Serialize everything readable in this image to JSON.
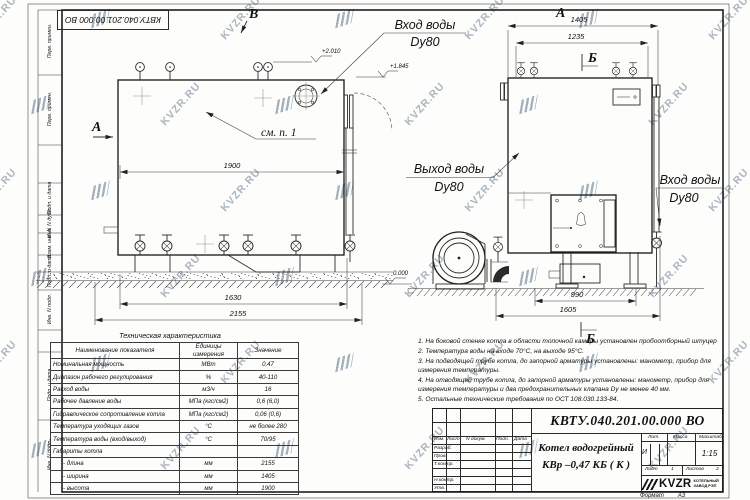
{
  "watermark": {
    "text": "KVZR.RU"
  },
  "frame": {
    "stamp": "КВТУ.040.201.00.000 ВО",
    "margin_labels": [
      "Перв. примен.",
      "Перв. примен.",
      "Подп. и дата",
      "Инв. N дубл.",
      "Взам. инв. N",
      "Подп. и дата",
      "Инв. N подл.",
      "Подп. и дата",
      "Инв. N подл."
    ]
  },
  "front_view": {
    "view_label_b": "В",
    "view_label_a": "А",
    "see_ref": "см. п. 1",
    "dim_1900": "1900",
    "dim_1630": "1630",
    "dim_2155": "2155",
    "elev_top": "+2.010",
    "elev_pipe": "+1.845",
    "inlet_line1": "Вход воды",
    "inlet_line2": "Dy80"
  },
  "side_view": {
    "view_label_a": "А",
    "section_label_top": "Б",
    "section_label_bottom": "Б",
    "dim_1405": "1405",
    "dim_1235": "1235",
    "dim_990": "990",
    "dim_1605": "1605",
    "elev_zero": "0.000",
    "outlet_line1": "Выход воды",
    "outlet_line2": "Dy80",
    "inlet_line1": "Вход воды",
    "inlet_line2": "Dy80"
  },
  "tech_table": {
    "title": "Техническая характеристика",
    "headers": [
      "Наименование показателя",
      "Единицы измерения",
      "Значение"
    ],
    "rows": [
      [
        "Номинальная мощность",
        "МВт",
        "0,47"
      ],
      [
        "Диапазон рабочего регулирования",
        "%",
        "40-110"
      ],
      [
        "Расход воды",
        "м3/ч",
        "16"
      ],
      [
        "Рабочее давление воды",
        "МПа (кгс/см2)",
        "0,6 (6,0)"
      ],
      [
        "Гидравлическое сопротивление котла",
        "МПа (кгс/см2)",
        "0,06 (0,6)"
      ],
      [
        "Температура уходящих газов",
        "°С",
        "не более 280"
      ],
      [
        "Температура воды (вход/выход)",
        "°С",
        "70/95"
      ],
      [
        "Габариты котла",
        "",
        ""
      ],
      [
        "- длина",
        "мм",
        "2155"
      ],
      [
        "- ширина",
        "мм",
        "1405"
      ],
      [
        "- высота",
        "мм",
        "1900"
      ]
    ]
  },
  "notes": [
    "1.  На боковой стенке котла в области топочной камеры установлен пробоотборный штуцер",
    "2.  Температура воды на входе  70°С,  на выходе  95°С.",
    "3.  На подводящей трубе котла, до запорной арматуры установлены:  манометр, прибор для измерения температуры.",
    "4.  На отводящей трубе котла, до запорной арматуры установлены:  манометр,  прибор для измерения температуры и два предохранительных клапана  Dу не менее  40 мм.",
    "5.  Остальные технические требования по ОСТ  108.030.133-84."
  ],
  "title_block": {
    "doc_number": "КВТУ.040.201.00.000  ВО",
    "product_line1": "Котел водогрейный",
    "product_line2": "КВр –0,47 КБ ( К )",
    "header_cols": [
      "Изм.",
      "Лист",
      "N докум.",
      "Подп.",
      "Дата"
    ],
    "row_labels": [
      "Разраб.",
      "Пров.",
      "Т.контр.",
      "Н.контр.",
      "Утв."
    ],
    "lit_label": "Лит.",
    "lit_value": "И",
    "mass_label": "Масса",
    "scale_label": "Масштаб",
    "scale_value": "1:15",
    "sheet_label": "Лист",
    "sheet_value": "1",
    "sheets_label": "Листов",
    "sheets_value": "2",
    "logo_text": "KVZR",
    "logo_sub1": "КОТЕЛЬНЫЙ",
    "logo_sub2": "ЗАВОД РЭП",
    "format_label": "Формат",
    "format_value": "А3"
  }
}
